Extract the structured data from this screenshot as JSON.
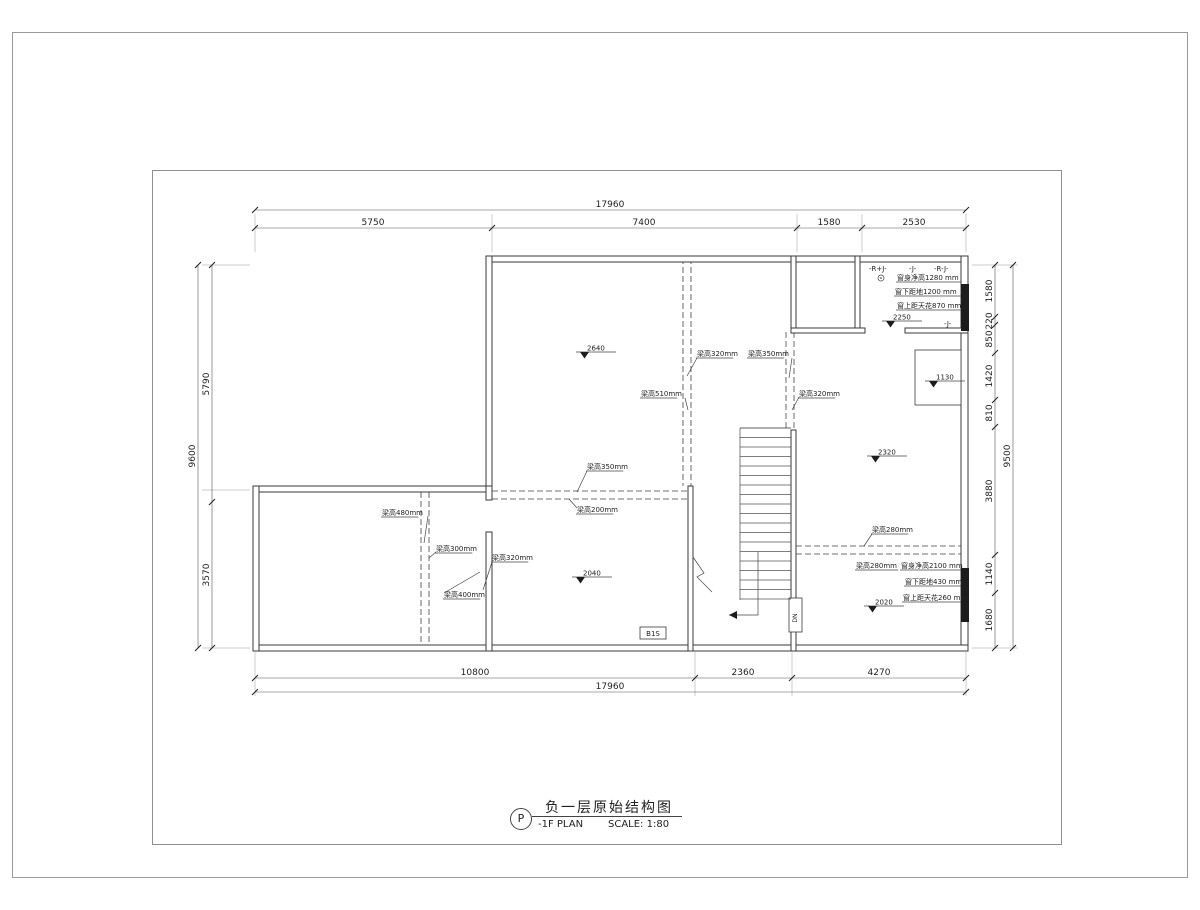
{
  "sheet": {
    "code": "P",
    "title_cn": "负一层原始结构图",
    "title_en": "-1F PLAN",
    "scale": "SCALE: 1:80"
  },
  "drawing": {
    "line_color": "#3a3a3a",
    "ext": [
      [
        255,
        214,
        255,
        252
      ],
      [
        492,
        214,
        492,
        252
      ],
      [
        797,
        214,
        797,
        252
      ],
      [
        862,
        214,
        862,
        252
      ],
      [
        966,
        214,
        966,
        252
      ],
      [
        255,
        652,
        255,
        696
      ],
      [
        695,
        652,
        695,
        696
      ],
      [
        792,
        652,
        792,
        696
      ],
      [
        966,
        652,
        966,
        696
      ],
      [
        202,
        265,
        250,
        265
      ],
      [
        202,
        490,
        250,
        490
      ],
      [
        202,
        648,
        250,
        648
      ],
      [
        972,
        265,
        1018,
        265
      ],
      [
        972,
        648,
        1018,
        648
      ]
    ],
    "chains": [
      {
        "dir": "h",
        "y": 210,
        "x1": 255,
        "x2": 966,
        "ticks": [
          255,
          966
        ],
        "labels": [
          {
            "t": "17960",
            "p": 610
          }
        ]
      },
      {
        "dir": "h",
        "y": 228,
        "x1": 255,
        "x2": 966,
        "ticks": [
          255,
          492,
          797,
          862,
          966
        ],
        "labels": [
          {
            "t": "5750",
            "p": 373
          },
          {
            "t": "7400",
            "p": 644
          },
          {
            "t": "1580",
            "p": 829
          },
          {
            "t": "2530",
            "p": 914
          }
        ]
      },
      {
        "dir": "h",
        "y": 678,
        "x1": 255,
        "x2": 966,
        "ticks": [
          255,
          695,
          792,
          966
        ],
        "labels": [
          {
            "t": "10800",
            "p": 475
          },
          {
            "t": "2360",
            "p": 743
          },
          {
            "t": "4270",
            "p": 879
          }
        ]
      },
      {
        "dir": "h",
        "y": 692,
        "x1": 255,
        "x2": 966,
        "ticks": [
          255,
          966
        ],
        "labels": [
          {
            "t": "17960",
            "p": 610
          }
        ]
      },
      {
        "dir": "v",
        "x": 198,
        "y1": 265,
        "y2": 648,
        "ticks": [
          265,
          648
        ],
        "labels": [
          {
            "t": "9600",
            "p": 456
          }
        ]
      },
      {
        "dir": "v",
        "x": 212,
        "y1": 265,
        "y2": 648,
        "ticks": [
          265,
          502,
          648
        ],
        "labels": [
          {
            "t": "5790",
            "p": 384
          },
          {
            "t": "3570",
            "p": 575
          }
        ]
      },
      {
        "dir": "v",
        "x": 995,
        "y1": 265,
        "y2": 648,
        "ticks": [
          265,
          317,
          325,
          353,
          400,
          427,
          555,
          593,
          648
        ],
        "labels": [
          {
            "t": "1580",
            "p": 291
          },
          {
            "t": "220",
            "p": 321
          },
          {
            "t": "850",
            "p": 339
          },
          {
            "t": "1420",
            "p": 376
          },
          {
            "t": "810",
            "p": 413
          },
          {
            "t": "3880",
            "p": 491
          },
          {
            "t": "1140",
            "p": 574
          },
          {
            "t": "1680",
            "p": 620
          }
        ]
      },
      {
        "dir": "v",
        "x": 1013,
        "y1": 265,
        "y2": 648,
        "ticks": [
          265,
          648
        ],
        "labels": [
          {
            "t": "9500",
            "p": 456
          }
        ]
      }
    ],
    "dashes": [
      [
        683,
        258,
        683,
        486
      ],
      [
        691,
        258,
        691,
        486
      ],
      [
        786,
        332,
        786,
        428
      ],
      [
        794,
        332,
        794,
        428
      ],
      [
        492,
        491,
        688,
        491
      ],
      [
        492,
        499,
        688,
        499
      ],
      [
        421,
        492,
        421,
        645
      ],
      [
        429,
        492,
        429,
        645
      ],
      [
        796,
        546,
        961,
        546
      ],
      [
        796,
        554,
        961,
        554
      ]
    ],
    "walls": [
      [
        488,
        256,
        480,
        6
      ],
      [
        961,
        256,
        7,
        392
      ],
      [
        253,
        645,
        715,
        6
      ],
      [
        486,
        256,
        6,
        236
      ],
      [
        253,
        486,
        239,
        6
      ],
      [
        253,
        486,
        6,
        165
      ],
      [
        486,
        486,
        6,
        14
      ],
      [
        486,
        532,
        6,
        119
      ],
      [
        688,
        486,
        5,
        165
      ],
      [
        791,
        256,
        5,
        76
      ],
      [
        791,
        430,
        5,
        221
      ],
      [
        855,
        256,
        5,
        76
      ],
      [
        791,
        328,
        74,
        5
      ],
      [
        905,
        328,
        63,
        5
      ]
    ],
    "fills": [
      [
        961,
        284,
        8,
        47
      ],
      [
        961,
        568,
        8,
        54
      ]
    ],
    "boxes": [
      [
        915,
        350,
        46,
        55
      ],
      [
        640,
        627,
        26,
        12
      ],
      [
        789,
        598,
        13,
        34
      ]
    ],
    "lines": [
      [
        740,
        428,
        740,
        600
      ],
      [
        740,
        428,
        791,
        428
      ],
      [
        486,
        500,
        492,
        500
      ],
      [
        486,
        532,
        492,
        532
      ]
    ],
    "stair": {
      "x1": 740,
      "x2": 791,
      "y1": 428,
      "y2": 599,
      "count": 19
    },
    "arrow": {
      "path": [
        [
          758,
          552
        ],
        [
          758,
          615
        ],
        [
          729,
          615
        ]
      ],
      "head": [
        [
          729,
          615
        ],
        [
          737,
          611
        ],
        [
          737,
          619
        ]
      ]
    },
    "zigzag": [
      [
        693,
        557
      ],
      [
        704,
        573
      ],
      [
        697,
        577
      ],
      [
        712,
        592
      ]
    ],
    "levels": [
      {
        "v": "2640",
        "x": 578,
        "y": 352
      },
      {
        "v": "2040",
        "x": 574,
        "y": 577
      },
      {
        "v": "2320",
        "x": 869,
        "y": 456
      },
      {
        "v": "1130",
        "x": 927,
        "y": 381
      },
      {
        "v": "2250",
        "x": 884,
        "y": 321
      },
      {
        "v": "2020",
        "x": 866,
        "y": 606
      }
    ],
    "beam_labels": [
      {
        "t": "梁高320mm",
        "x": 697,
        "y": 356,
        "leader": [
          [
            697,
            358
          ],
          [
            687,
            376
          ]
        ]
      },
      {
        "t": "梁高350mm",
        "x": 748,
        "y": 356,
        "leader": [
          [
            792,
            358
          ],
          [
            789,
            378
          ]
        ]
      },
      {
        "t": "梁高510mm",
        "x": 641,
        "y": 396,
        "leader": [
          [
            685,
            398
          ],
          [
            688,
            410
          ]
        ]
      },
      {
        "t": "梁高320mm",
        "x": 799,
        "y": 396,
        "leader": [
          [
            799,
            397
          ],
          [
            792,
            410
          ]
        ]
      },
      {
        "t": "梁高350mm",
        "x": 587,
        "y": 469,
        "leader": [
          [
            587,
            471
          ],
          [
            577,
            492
          ]
        ]
      },
      {
        "t": "梁高200mm",
        "x": 577,
        "y": 512,
        "leader": [
          [
            577,
            508
          ],
          [
            569,
            499
          ]
        ]
      },
      {
        "t": "梁高480mm",
        "x": 382,
        "y": 515,
        "leader": [
          [
            428,
            516
          ],
          [
            424,
            543
          ]
        ]
      },
      {
        "t": "梁高300mm",
        "x": 436,
        "y": 551,
        "leader": [
          [
            436,
            552
          ],
          [
            429,
            558
          ]
        ]
      },
      {
        "t": "梁高320mm",
        "x": 492,
        "y": 560,
        "leader": [
          [
            492,
            562
          ],
          [
            483,
            590
          ]
        ]
      },
      {
        "t": "梁高400mm",
        "x": 444,
        "y": 597,
        "leader": [
          [
            444,
            593
          ],
          [
            480,
            572
          ]
        ]
      },
      {
        "t": "梁高280mm",
        "x": 872,
        "y": 532,
        "leader": [
          [
            872,
            534
          ],
          [
            864,
            546
          ]
        ]
      }
    ],
    "notes": [
      {
        "t": "窗身净高1280 mm",
        "x": 897,
        "y": 280,
        "e": 961
      },
      {
        "t": "窗下距地1200 mm",
        "x": 895,
        "y": 294,
        "e": 961
      },
      {
        "t": "窗上距天花870 mm",
        "x": 897,
        "y": 308,
        "e": 961
      },
      {
        "t": "梁高280mm",
        "x": 856,
        "y": 568,
        "e": 898
      },
      {
        "t": "窗身净高2100 mm",
        "x": 901,
        "y": 568,
        "e": 961
      },
      {
        "t": "窗下距地430 mm",
        "x": 905,
        "y": 584,
        "e": 961
      },
      {
        "t": "窗上距天花260 mm",
        "x": 903,
        "y": 600,
        "e": 961
      }
    ],
    "tags": [
      {
        "t": "-R+J-",
        "x": 869,
        "y": 271
      },
      {
        "t": "-J-",
        "x": 909,
        "y": 271
      },
      {
        "t": "-R-J-",
        "x": 934,
        "y": 271
      },
      {
        "t": "-J-",
        "x": 944,
        "y": 326
      }
    ],
    "small_labels": [
      {
        "t": "B1S",
        "x": 653,
        "y": 636,
        "anchor": "middle",
        "size": 7
      }
    ],
    "rotated_labels": [
      {
        "t": "DN",
        "x": 797,
        "y": 618,
        "size": 6
      }
    ],
    "circle_symbol": {
      "x": 881,
      "y": 278,
      "r": 3
    }
  }
}
